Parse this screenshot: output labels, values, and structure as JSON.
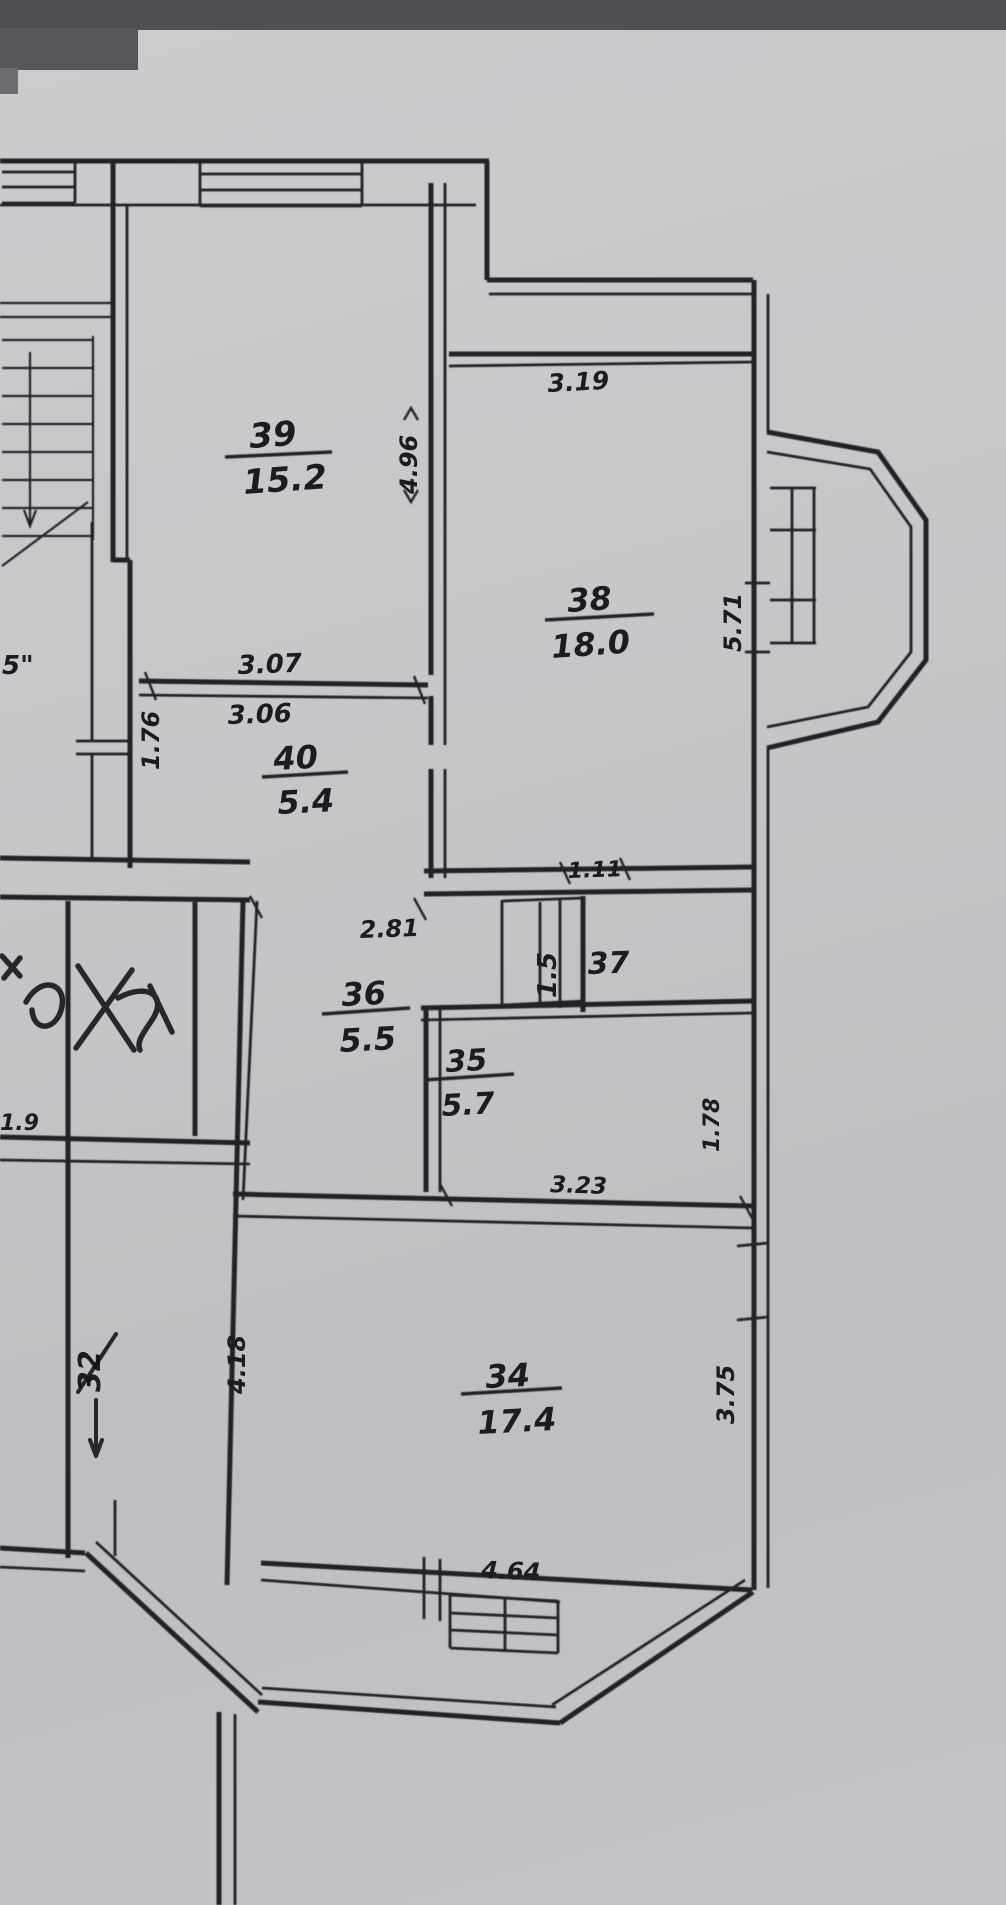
{
  "document": {
    "kind": "scanned apartment floor plan (photo of paper drawing)"
  },
  "colors": {
    "paper": "#c7c7ca",
    "ink": "#232328",
    "pen_scribble": "#121216",
    "photo_edge_band": "#4e4e53"
  },
  "plan": {
    "rooms": [
      {
        "number": "39",
        "area": "15.2"
      },
      {
        "number": "38",
        "area": "18.0"
      },
      {
        "number": "40",
        "area": "5.4"
      },
      {
        "number": "36",
        "area": "5.5"
      },
      {
        "number": "37",
        "area": "1.5"
      },
      {
        "number": "35",
        "area": "5.7"
      },
      {
        "number": "34",
        "area": "17.4"
      },
      {
        "number": "32",
        "area": ""
      }
    ],
    "dimensions": [
      {
        "value": "3.19",
        "location": "top of room 38"
      },
      {
        "value": "4.96",
        "location": "left side of room 38 wall, vertical"
      },
      {
        "value": "5.71",
        "location": "right side of room 38, vertical"
      },
      {
        "value": "3.07",
        "location": "above wall between rooms 39 and 40"
      },
      {
        "value": "3.06",
        "location": "below wall between rooms 39 and 40"
      },
      {
        "value": "1.76",
        "location": "left wall of room 40, vertical"
      },
      {
        "value": "1.11",
        "location": "bottom of room 38"
      },
      {
        "value": "2.81",
        "location": "top of room 36"
      },
      {
        "value": "3.23",
        "location": "bottom of room 35"
      },
      {
        "value": "1.78",
        "location": "right side of room 35, vertical"
      },
      {
        "value": "4.64",
        "location": "bottom of room 34"
      },
      {
        "value": "3.75",
        "location": "right side of room 34, vertical"
      },
      {
        "value": "4.18",
        "location": "left side of room 34, vertical"
      },
      {
        "value": "1.9",
        "location": "left edge, partially cut off"
      },
      {
        "value": "5\"",
        "location": "left edge near stairs, partially cut off"
      }
    ],
    "annotations": [
      {
        "note": "pen scribble crossing out room label in left rooms"
      },
      {
        "note": "room number 32 struck through with pen, arrow below"
      }
    ]
  }
}
